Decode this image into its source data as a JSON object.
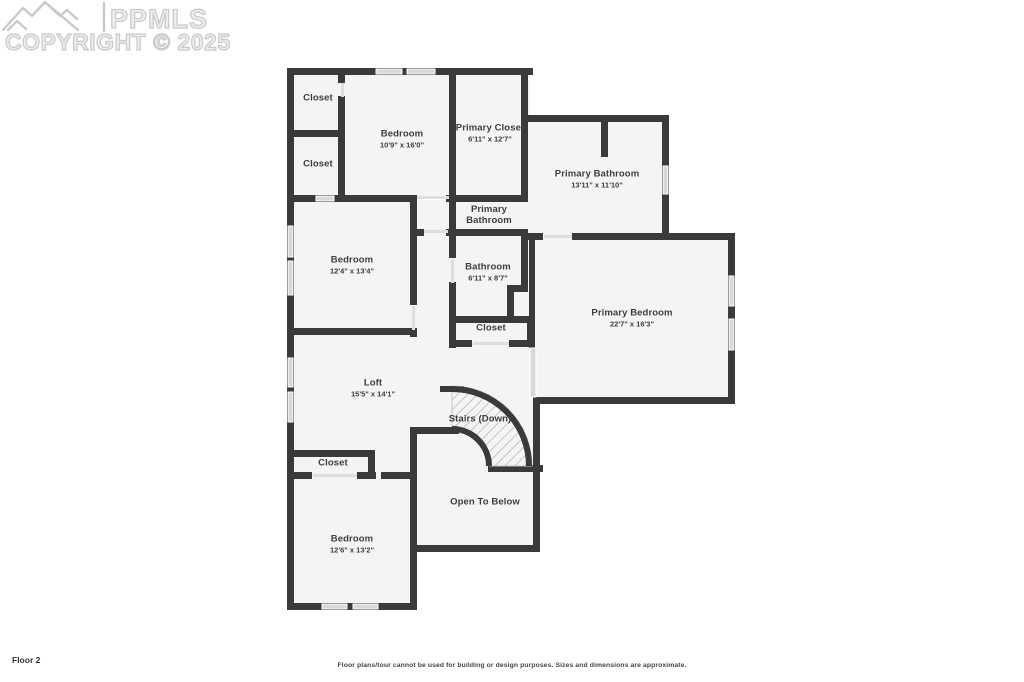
{
  "watermark": {
    "brand": "PPMLS",
    "copyright": "COPYRIGHT © 2025"
  },
  "colors": {
    "wall": "#3a3a3a",
    "room_fill": "#f4f4f4",
    "window_fill": "#d9d9d9",
    "hatch_line": "#b8b8b8",
    "watermark": "#c9c9c9"
  },
  "rooms": [
    {
      "name": "Closet",
      "dims": ""
    },
    {
      "name": "Bedroom",
      "dims": "10'9\" x 16'0\""
    },
    {
      "name": "Primary Closet",
      "dims": "6'11\" x 12'7\""
    },
    {
      "name": "Closet",
      "dims": ""
    },
    {
      "name": "Primary Bathroom",
      "dims": "13'11\" x 11'10\""
    },
    {
      "name": "Primary Bathroom",
      "dims": ""
    },
    {
      "name": "Bedroom",
      "dims": "12'4\" x 13'4\""
    },
    {
      "name": "Bathroom",
      "dims": "6'11\" x 8'7\""
    },
    {
      "name": "Primary Bedroom",
      "dims": "22'7\" x 16'3\""
    },
    {
      "name": "Closet",
      "dims": ""
    },
    {
      "name": "Loft",
      "dims": "15'5\" x 14'1\""
    },
    {
      "name": "Stairs (Down)",
      "dims": ""
    },
    {
      "name": "Closet",
      "dims": ""
    },
    {
      "name": "Open To Below",
      "dims": ""
    },
    {
      "name": "Bedroom",
      "dims": "12'6\" x 13'2\""
    }
  ],
  "footer": {
    "floor_label": "Floor 2",
    "disclaimer": "Floor plans/tour cannot be used for building or design purposes. Sizes and dimensions are approximate."
  }
}
